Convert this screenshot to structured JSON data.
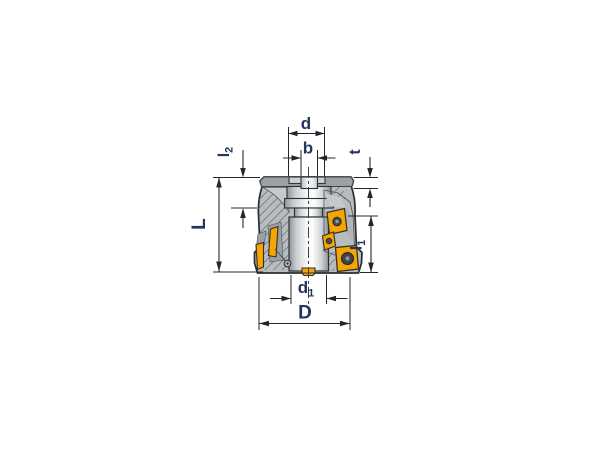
{
  "drawing": {
    "kind": "technical-dimension-drawing",
    "subject": "indexable face milling cutter, sectioned side view",
    "background": "#ffffff",
    "colors": {
      "line": "#23272b",
      "label": "#24365c",
      "body": "#b7bcbf",
      "body_band": "#9ba1a5",
      "recess_floor": "#cdd1d3",
      "pocket": "#9aa0a4",
      "pocket_light": "#c5c9cc",
      "insert_orange": "#f7a600",
      "screw": "#4a4f54",
      "screw_dark": "#3f444a",
      "hatch_line": "#4e545a"
    },
    "dimensions": {
      "d": {
        "base": "d",
        "sub": "",
        "position": "top"
      },
      "b": {
        "base": "b",
        "sub": "",
        "position": "top"
      },
      "t": {
        "base": "t",
        "sub": "",
        "position": "top-right"
      },
      "l2": {
        "base": "l",
        "sub": "2",
        "position": "top-left"
      },
      "L": {
        "base": "L",
        "sub": "",
        "position": "left"
      },
      "l1": {
        "base": "l",
        "sub": "1",
        "position": "right"
      },
      "d1": {
        "base": "d",
        "sub": "1",
        "position": "bottom"
      },
      "D": {
        "base": "D",
        "sub": "",
        "position": "bottom"
      }
    }
  }
}
